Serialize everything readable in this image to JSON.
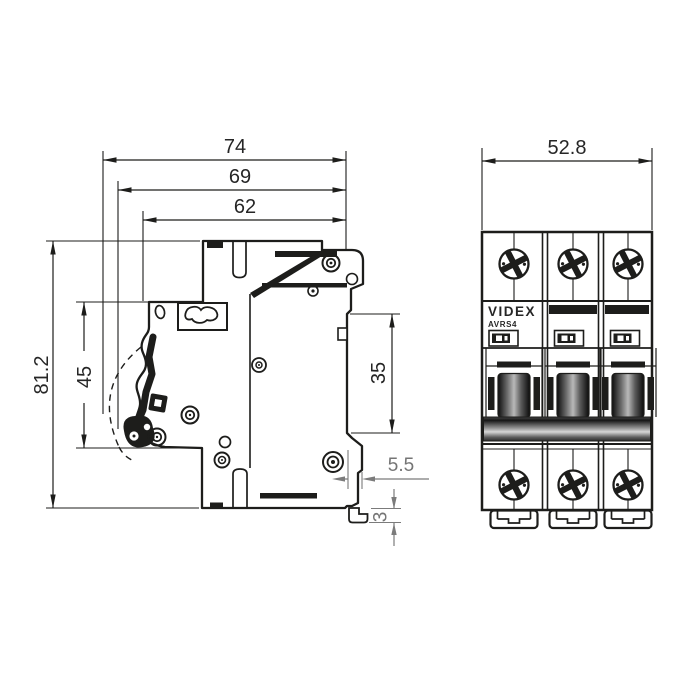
{
  "colors": {
    "ink": "#1d1d1b",
    "secondary_dim": "#7b7b7b",
    "background": "#ffffff"
  },
  "side_view": {
    "dim_total_width_mm": "74",
    "dim_lever_width_mm": "69",
    "dim_body_width_mm": "62",
    "dim_total_height_mm": "81.2",
    "dim_front_height_mm": "45",
    "dim_din_rail_mm": "35",
    "dim_clip_offset_mm": "5.5",
    "dim_clip_depth_mm": "3"
  },
  "front_view": {
    "dim_width_mm": "52.8",
    "brand": "VIDEX",
    "model": "AVRS4"
  }
}
